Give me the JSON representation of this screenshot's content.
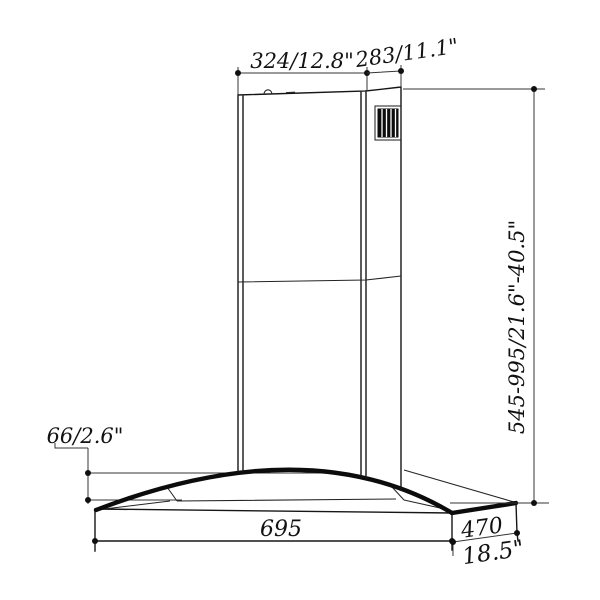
{
  "page": {
    "background": "#ffffff",
    "description": "Technical dimension line drawing of a chimney range hood with curved glass canopy"
  },
  "drawing": {
    "subject": "island-chimney-range-hood",
    "line_color": "#161616",
    "glass_edge_color": "#0c0c0c",
    "grille_color": "#0d0d0d",
    "labels": {
      "chimney_width": "324/12.8\"",
      "chimney_depth": "283/11.1\"",
      "height_range": "545-995/21.6\"-40.5\"",
      "canopy_edge_height": "66/2.6\"",
      "base_width_mm": "695",
      "base_depth_mm": "470",
      "base_depth_in": "18.5\""
    }
  }
}
